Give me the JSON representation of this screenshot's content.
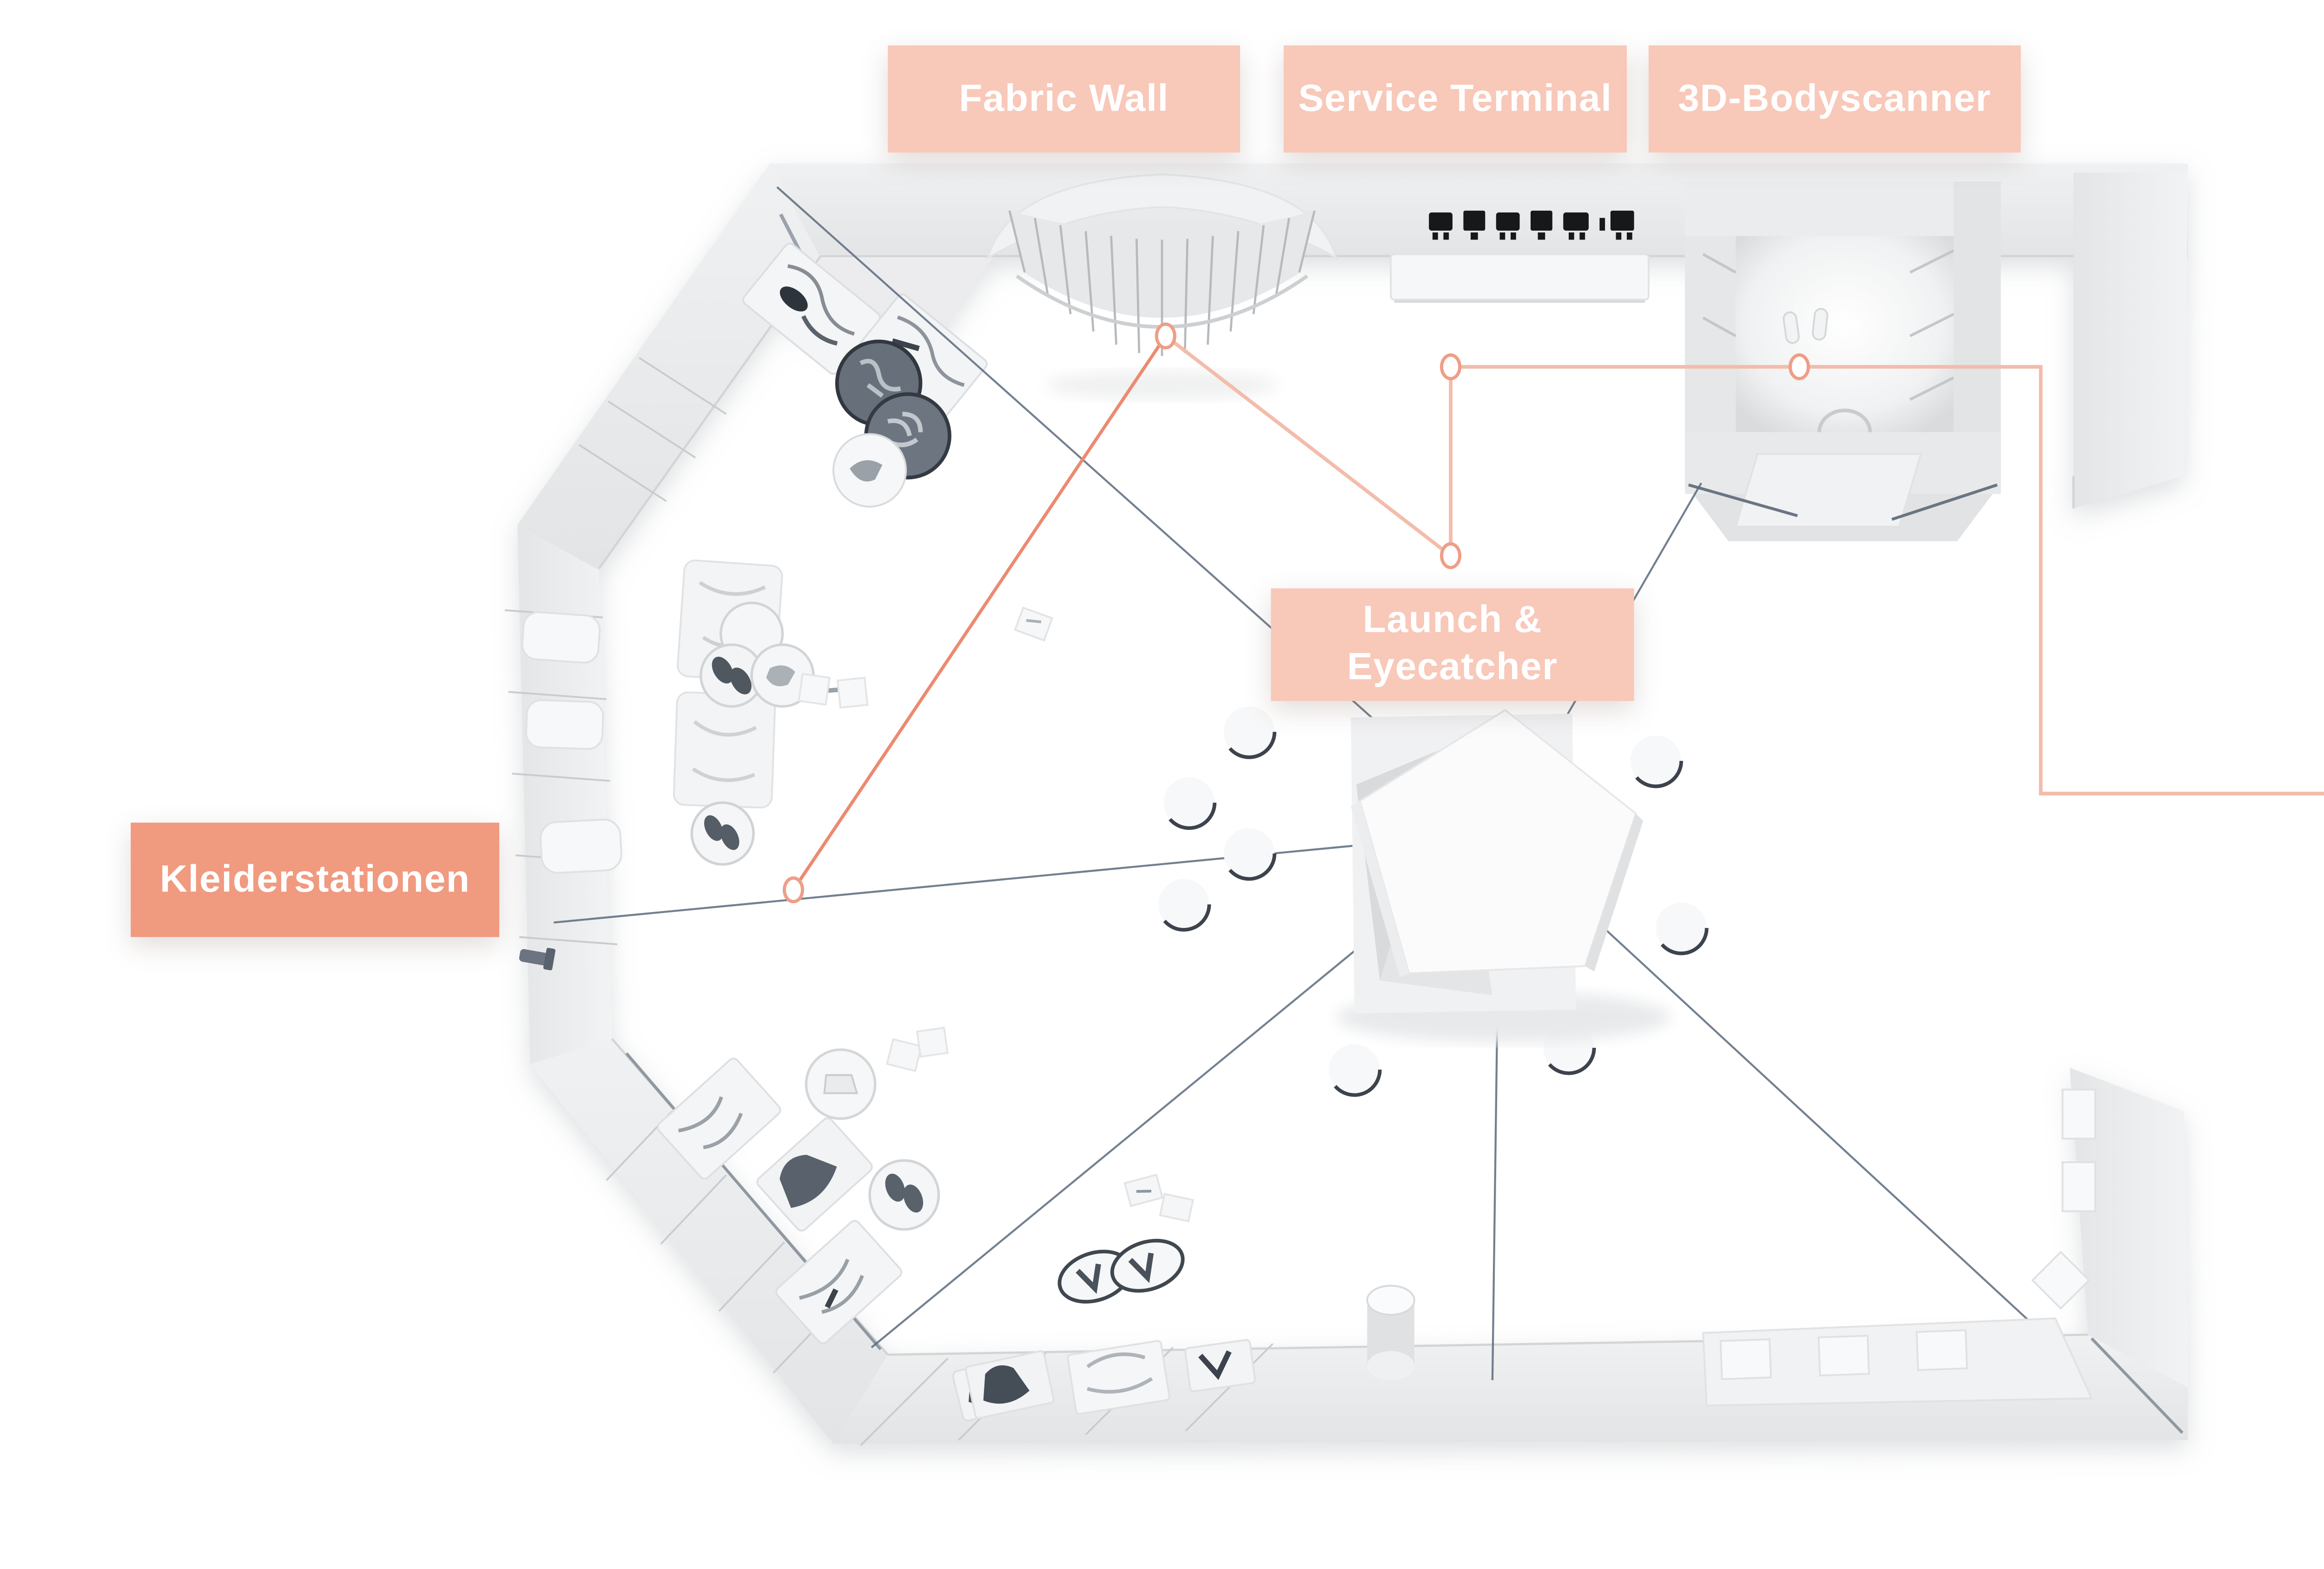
{
  "labels": {
    "fabric_wall": {
      "text": "Fabric Wall"
    },
    "service_terminal": {
      "text": "Service Terminal"
    },
    "bodyscanner": {
      "text": "3D-Bodyscanner"
    },
    "launch_eyecatcher": {
      "line1": "Launch &",
      "line2": "Eyecatcher"
    },
    "kleiderstationen": {
      "text": "Kleiderstationen"
    }
  },
  "colors": {
    "label_bg": "#f8c8b9",
    "label_bg_accent": "#f09a80",
    "label_text": "#ffffff",
    "journey_line": "#f3bcab",
    "journey_accent": "#ec8a70",
    "journey_node_stroke": "#ef9e87",
    "sight_line": "#5a6a7b",
    "wall_fill": "#e9eaec",
    "wall_edge": "#cbced1",
    "floor": "#ffffff",
    "dark_item": "#4a525c"
  },
  "icons": {
    "terminal_devices": "row of 6 black device glyphs on service wall",
    "footprints": "scanner floor footprint marks"
  }
}
